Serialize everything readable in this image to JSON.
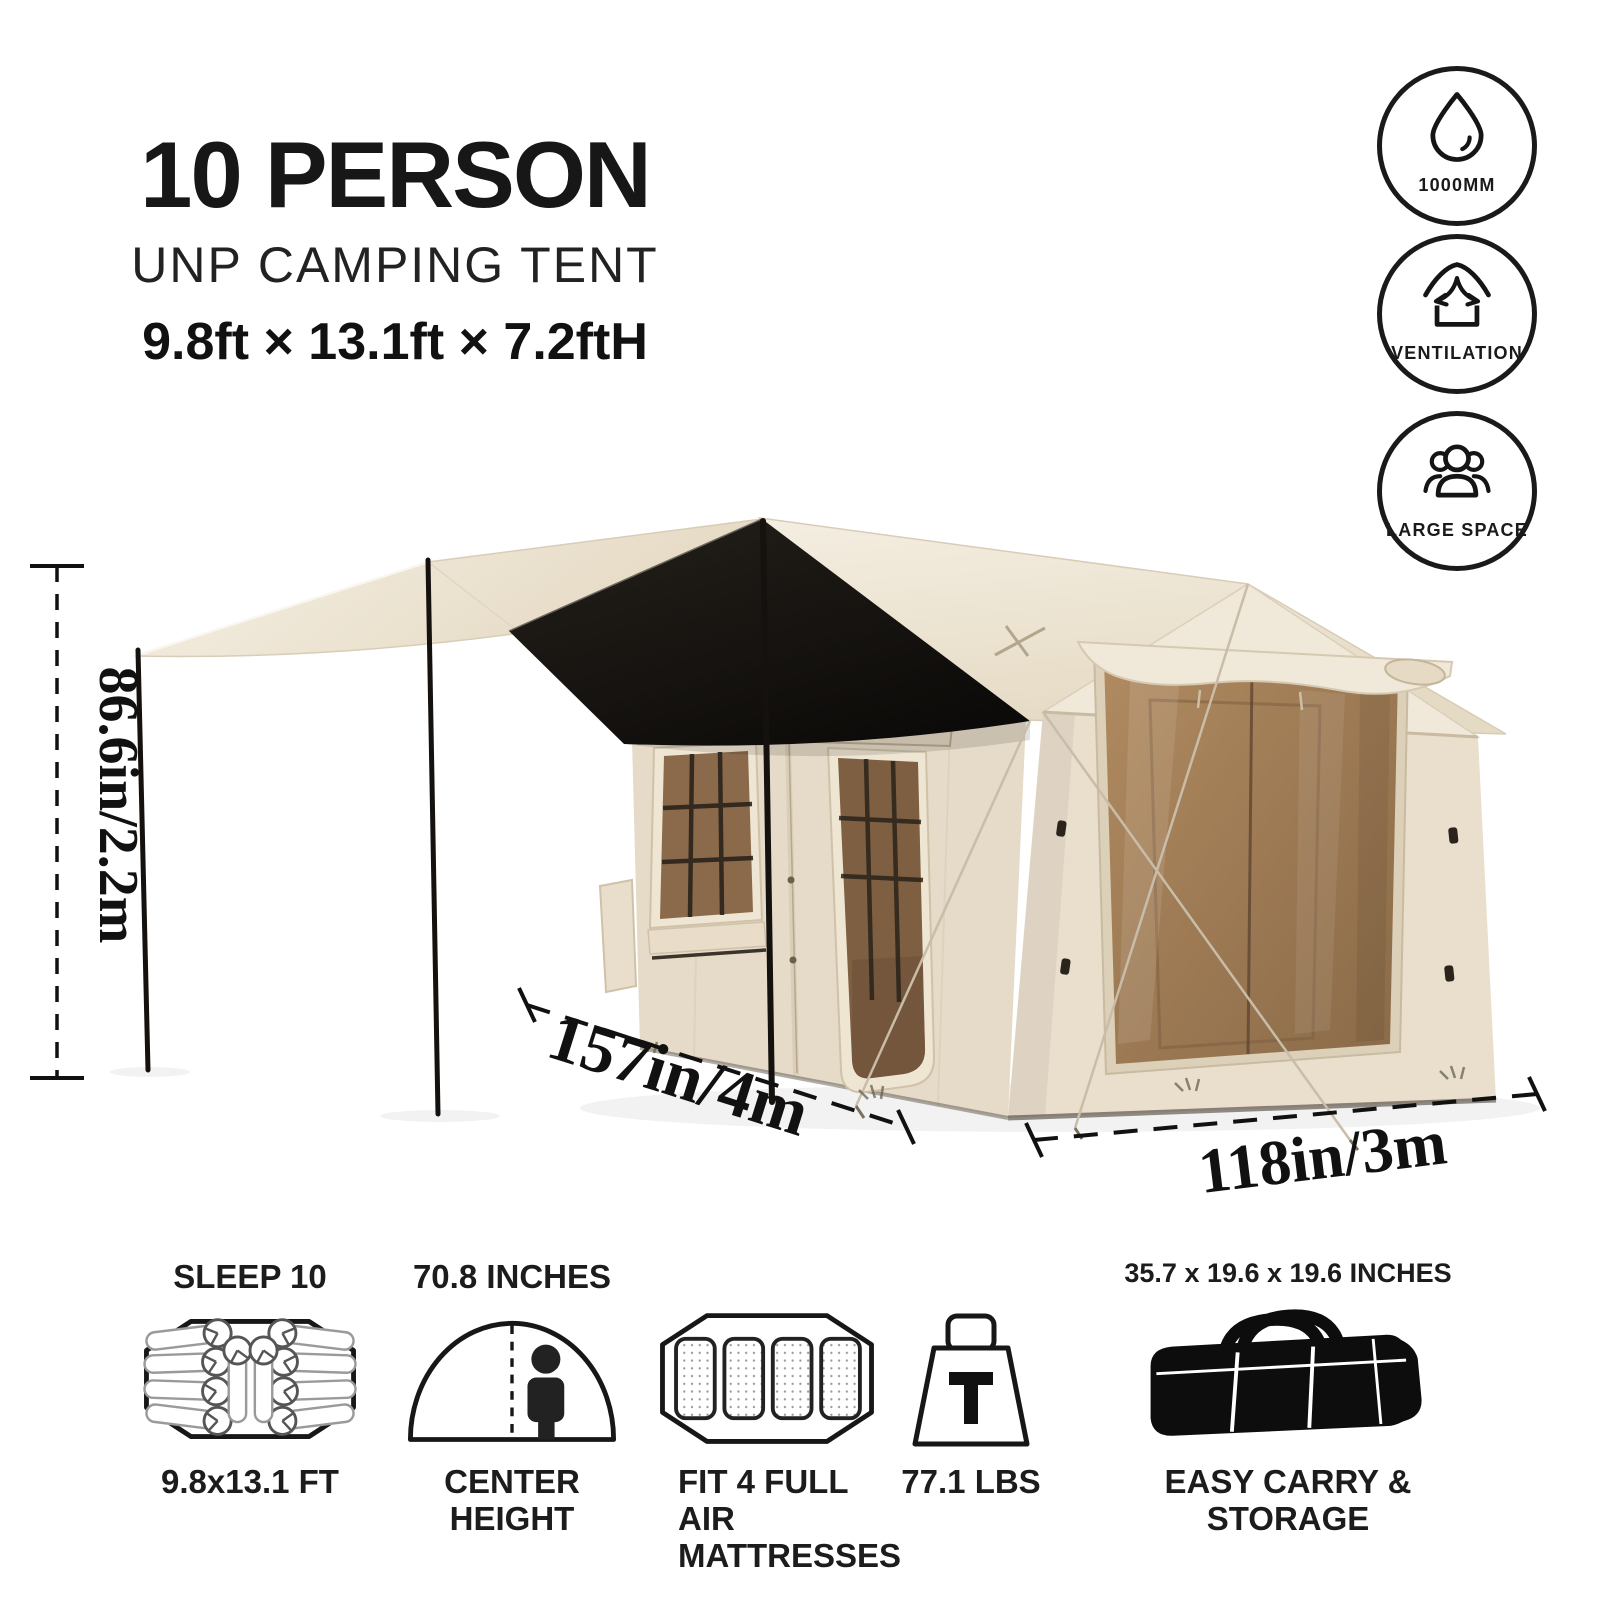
{
  "header": {
    "title": "10 PERSON",
    "subtitle": "UNP CAMPING TENT",
    "size_line": "9.8ft × 13.1ft × 7.2ftH"
  },
  "badges": [
    {
      "icon": "water-drop-icon",
      "label": "1000MM"
    },
    {
      "icon": "ventilation-icon",
      "label": "VENTILATION"
    },
    {
      "icon": "large-space-icon",
      "label": "LARGE SPACE"
    }
  ],
  "dimensions": {
    "height_label": "86.6in/2.2m",
    "length_label": "157in/4m",
    "width_label": "118in/3m"
  },
  "features": [
    {
      "icon": "floor-plan-icon",
      "top": "SLEEP 10",
      "bottom": "9.8x13.1 FT"
    },
    {
      "icon": "center-height-icon",
      "top": "70.8 INCHES",
      "bottom": "CENTER HEIGHT"
    },
    {
      "icon": "air-mattresses-icon",
      "top": "",
      "bottom": "FIT 4 FULL AIR\nMATTRESSES"
    },
    {
      "icon": "weight-icon",
      "top": "",
      "bottom": "77.1 LBS"
    },
    {
      "icon": "carry-bag-icon",
      "top": "35.7 x 19.6 x 19.6 INCHES",
      "bottom": "EASY CARRY & STORAGE"
    }
  ],
  "colors": {
    "tent_canvas": "#ece2d1",
    "mesh_brown": "#96744f",
    "canopy_black": "#171310",
    "ink": "#1a1a1a"
  }
}
